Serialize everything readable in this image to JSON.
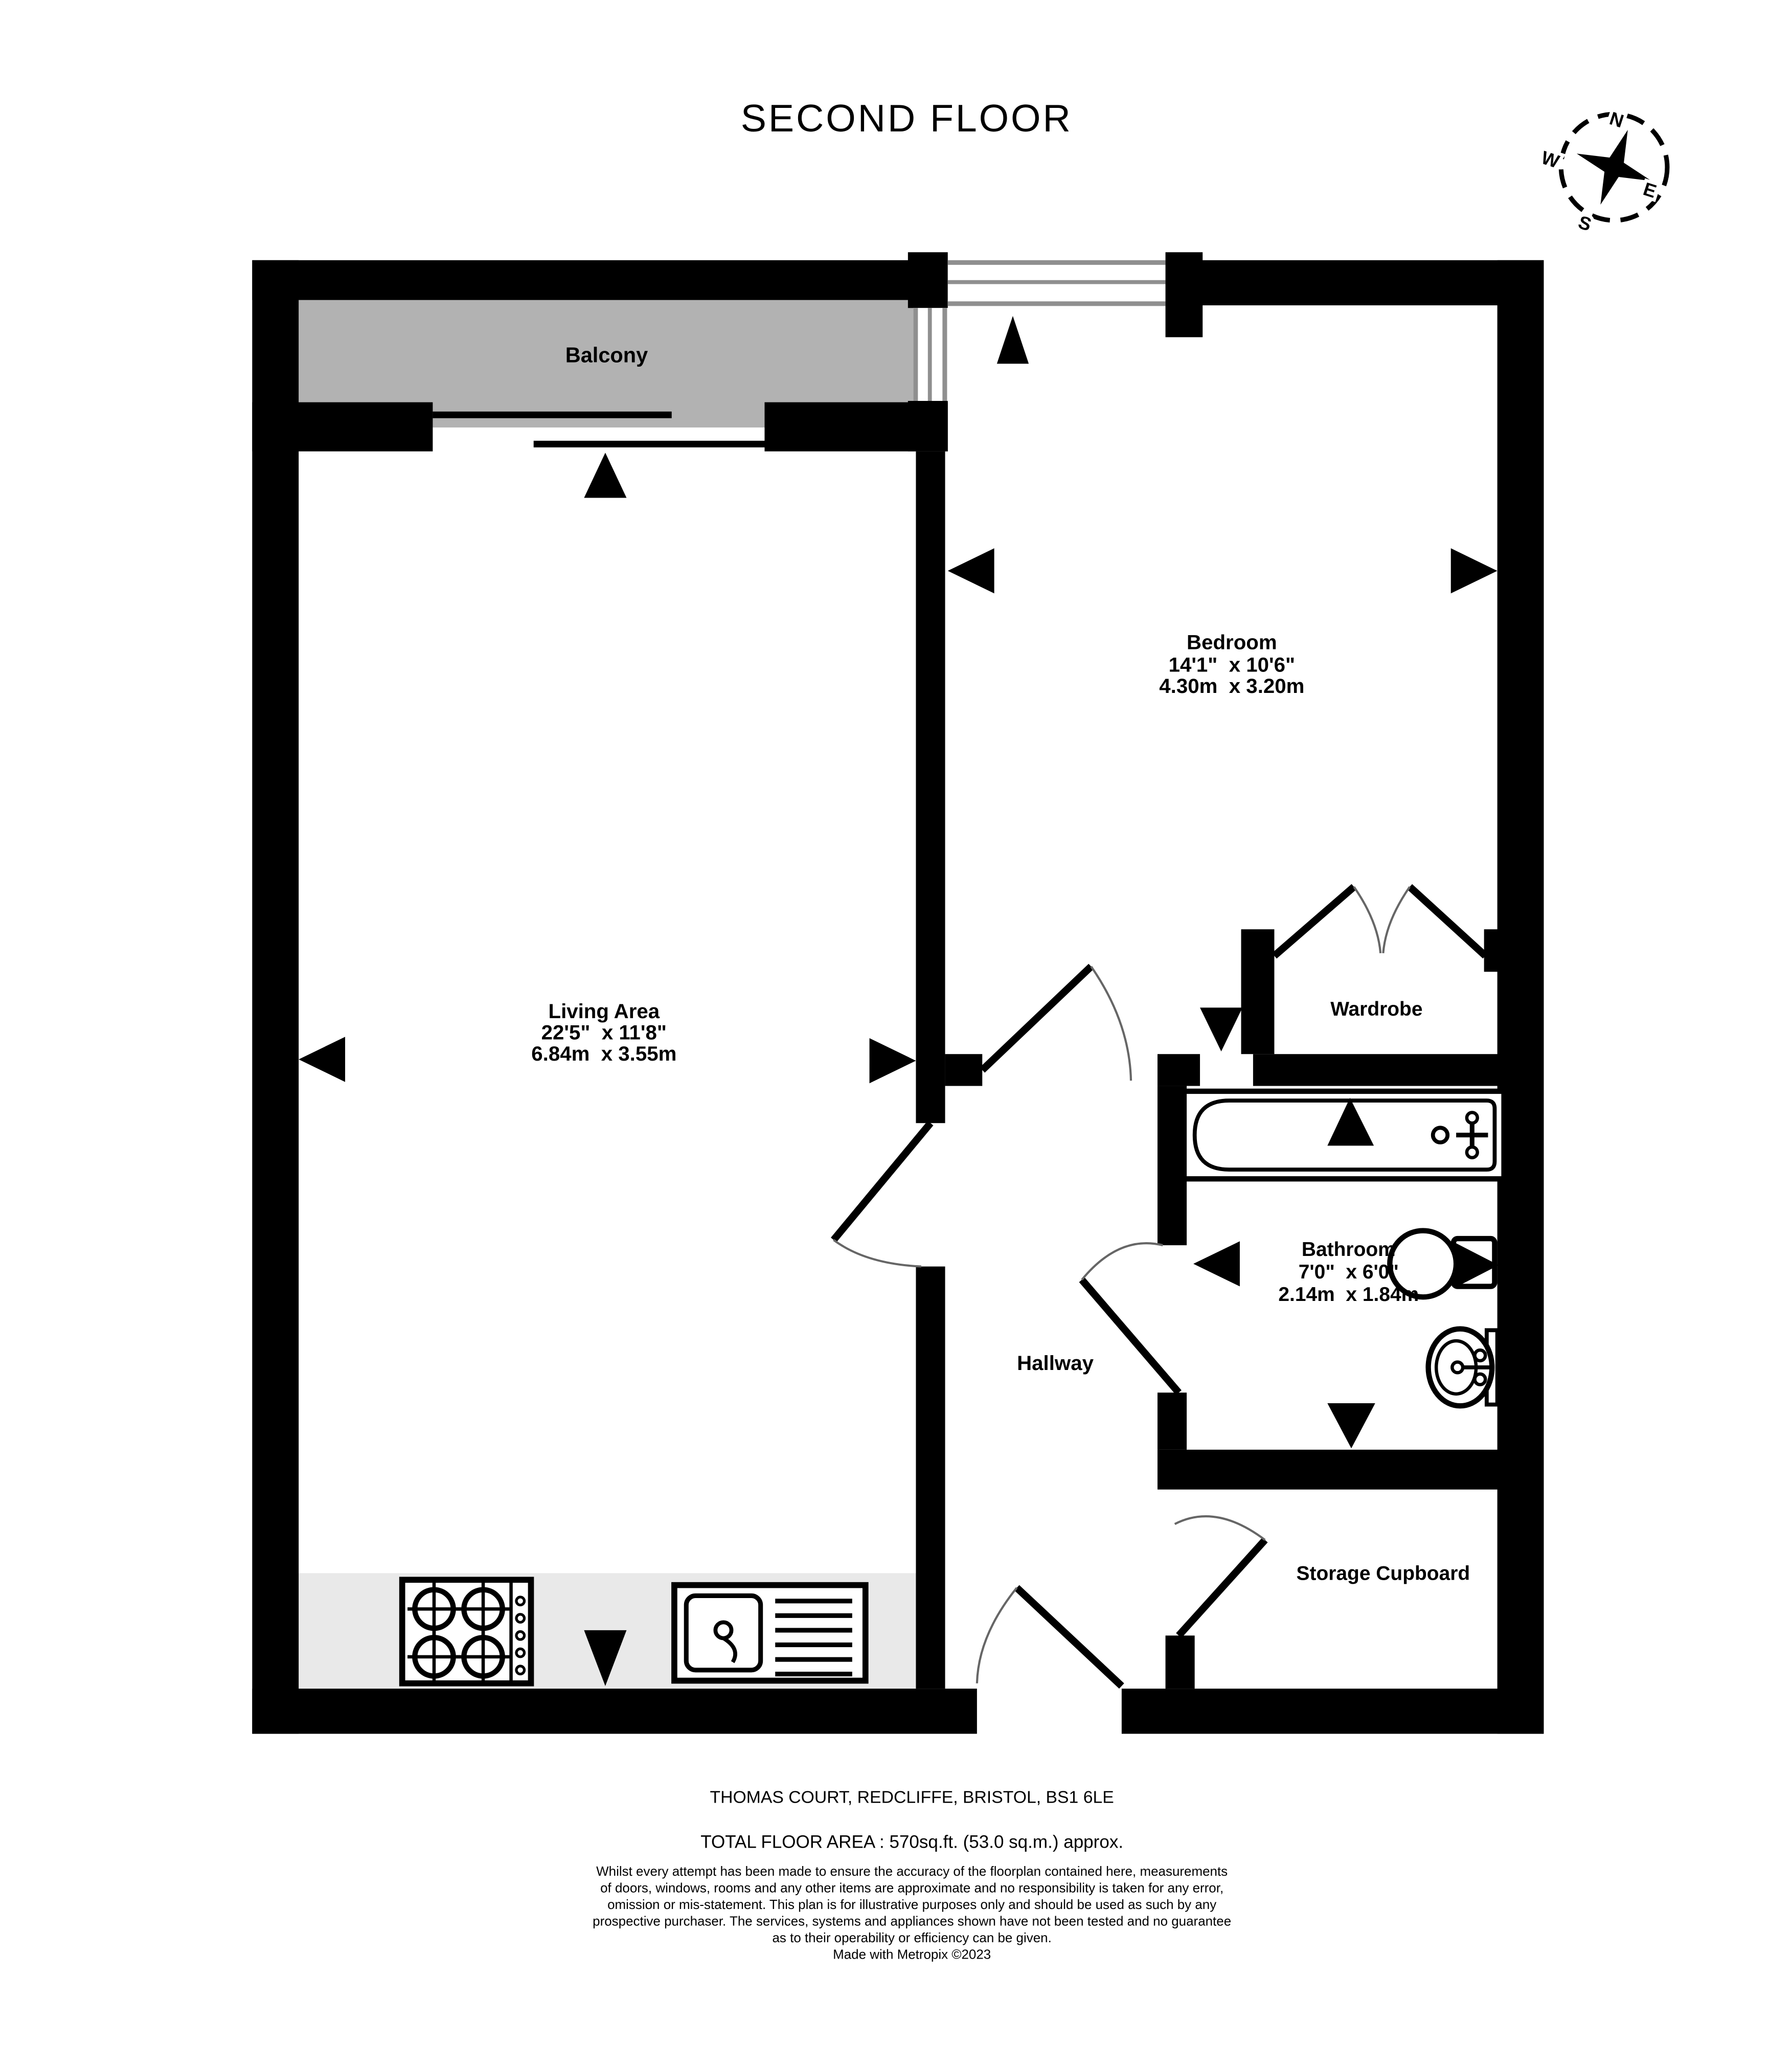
{
  "title": "SECOND FLOOR",
  "compass": {
    "north": "N",
    "east": "E",
    "south": "S",
    "west": "W"
  },
  "rooms": {
    "balcony": {
      "label": "Balcony"
    },
    "bedroom": {
      "label": "Bedroom",
      "dim_imperial": "14'1\"  x 10'6\"",
      "dim_metric": "4.30m  x 3.20m"
    },
    "living_area": {
      "label": "Living Area",
      "dim_imperial": "22'5\"  x 11'8\"",
      "dim_metric": "6.84m  x 3.55m"
    },
    "wardrobe": {
      "label": "Wardrobe"
    },
    "bathroom": {
      "label": "Bathroom",
      "dim_imperial": "7'0\"  x 6'0\"",
      "dim_metric": "2.14m  x 1.84m"
    },
    "hallway": {
      "label": "Hallway"
    },
    "storage_cupboard": {
      "label": "Storage Cupboard"
    }
  },
  "footer": {
    "address": "THOMAS COURT, REDCLIFFE, BRISTOL, BS1 6LE",
    "total_area": "TOTAL FLOOR AREA : 570sq.ft. (53.0 sq.m.) approx.",
    "disclaimer_lines": [
      "Whilst every attempt has been made to ensure the accuracy of the floorplan contained here, measurements",
      "of doors, windows, rooms and any other items are approximate and no responsibility is taken for any error,",
      "omission or mis-statement. This plan is for illustrative purposes only and should be used as such by any",
      "prospective purchaser. The services, systems and appliances shown have not been tested and no guarantee",
      "as to their operability or efficiency can be given."
    ],
    "credit": "Made with Metropix ©2023"
  },
  "colors": {
    "wall": "#000000",
    "balcony_fill": "#b2b2b2",
    "counter_fill": "#e9e9e9",
    "window_line_gray": "#8f8f8f",
    "door_arc": "#666666"
  }
}
